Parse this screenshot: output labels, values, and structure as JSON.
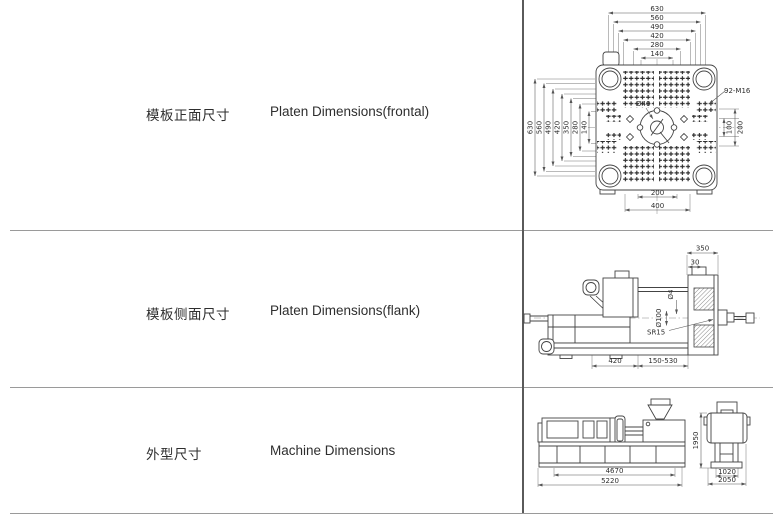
{
  "colors": {
    "drawing_line": "#444444",
    "dim_line": "#555555",
    "border_horizontal": "#9a9a9a",
    "border_vertical": "#5a5a5a",
    "text": "#2e2e2e"
  },
  "rows": [
    {
      "label_cn": "模板正面尺寸",
      "label_en": "Platen Dimensions(frontal)"
    },
    {
      "label_cn": "模板侧面尺寸",
      "label_en": "Platen Dimensions(flank)"
    },
    {
      "label_cn": "外型尺寸",
      "label_en": "Machine Dimensions"
    }
  ],
  "drawings": {
    "platen_frontal": {
      "top_dims": [
        "630",
        "560",
        "490",
        "420",
        "280",
        "140"
      ],
      "left_dims": [
        "630",
        "560",
        "490",
        "420",
        "350",
        "280",
        "140"
      ],
      "right_dims": [
        "100",
        "200"
      ],
      "bottom_dims": [
        "200",
        "400"
      ],
      "center_hole": "Ø40",
      "bolt_pattern": "92-M16"
    },
    "platen_flank": {
      "top_dim": "350",
      "offset_dim": "30",
      "nozzle_dia": "Ø4",
      "ring_dia": "Ø100",
      "sphere_radius": "SR15",
      "base_dim": "420",
      "stroke_range": "150-530"
    },
    "machine": {
      "length_inner": "4670",
      "length_total": "5220",
      "height": "1950",
      "width_inner": "1020",
      "width_total": "2050"
    }
  }
}
